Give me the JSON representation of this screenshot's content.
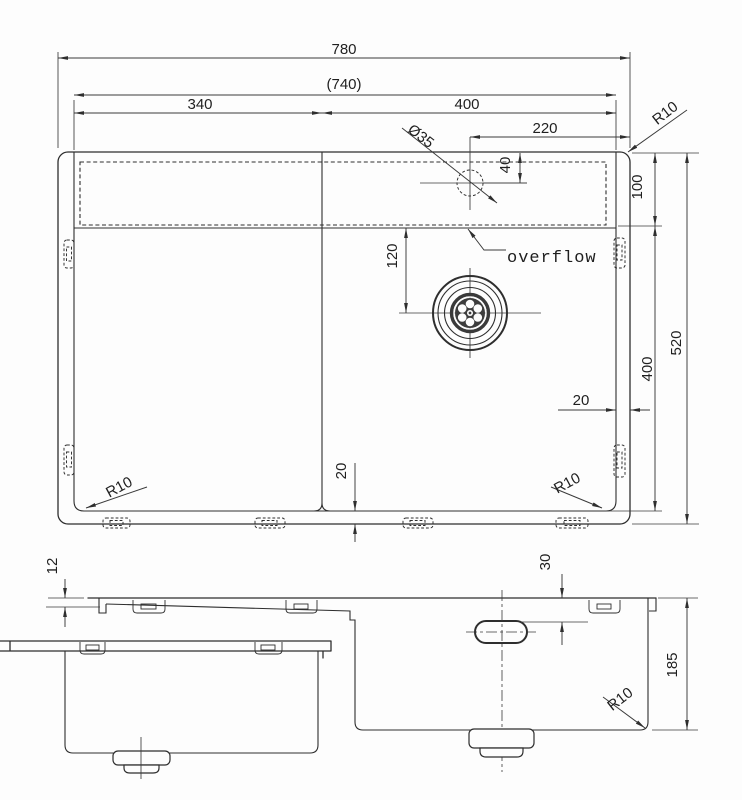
{
  "drawing": {
    "type": "technical-drawing",
    "subject": "kitchen sink dimension drawing",
    "line_color": "#2e2e2e",
    "background": "#fdfdfd",
    "top_view": {
      "dimensions": {
        "overall_width": "780",
        "cutout_width": "(740)",
        "left_section_width": "340",
        "right_section_width": "400",
        "tap_hole_offset": "220",
        "tap_hole_diameter": "Ø35",
        "tap_hole_from_edge": "40",
        "rear_channel_depth": "100",
        "drain_offset": "120",
        "bowl_front_depth": "400",
        "overall_depth": "520",
        "right_flange": "20",
        "bottom_flange": "20",
        "corner_radius_top_right": "R10",
        "corner_radius_bottom_left": "R10",
        "corner_radius_bottom_right": "R10"
      },
      "annotations": {
        "overflow_label": "overflow"
      }
    },
    "front_view": {
      "dimensions": {
        "rim_drop": "12",
        "overflow_offset": "30",
        "bowl_depth": "185",
        "corner_radius": "R10"
      }
    }
  }
}
